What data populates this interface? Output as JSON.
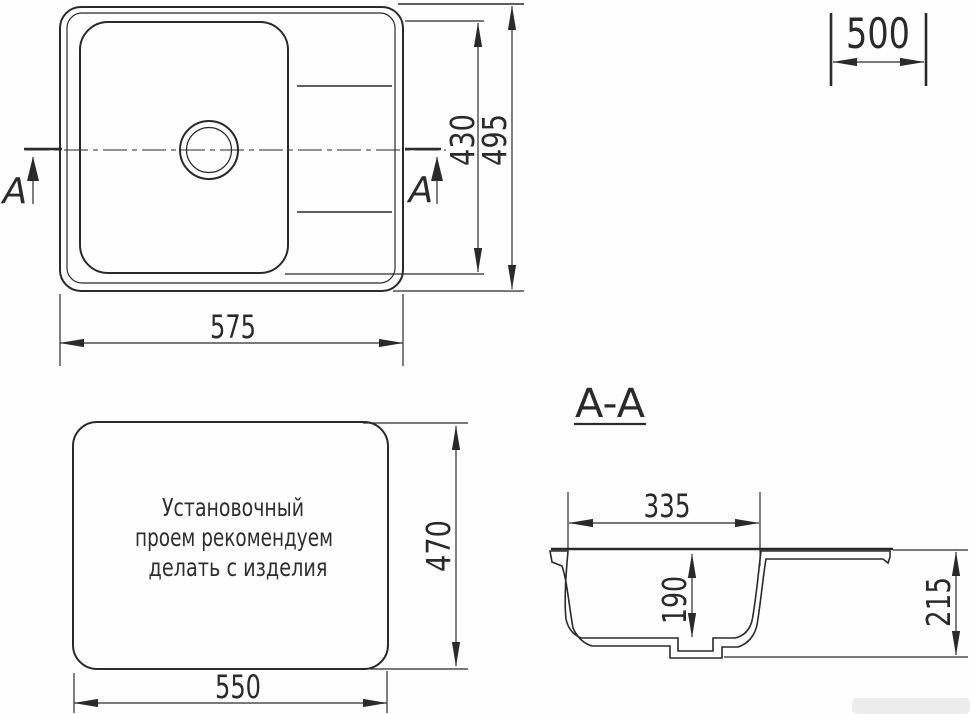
{
  "drawing": {
    "line_color": "#2a2a2a",
    "background": "#ffffff",
    "top_view": {
      "section_letter": "A",
      "width_label": "575",
      "bowl_height_label": "430",
      "overall_height_label": "495"
    },
    "corner_dim": {
      "label": "500"
    },
    "cutout_view": {
      "note_lines": [
        "Установочный",
        "проем рекомендуем",
        "делать с изделия"
      ],
      "width_label": "550",
      "height_label": "470"
    },
    "section_view": {
      "title": "A-A",
      "top_width_label": "335",
      "bowl_depth_label": "190",
      "overall_depth_label": "215"
    }
  }
}
